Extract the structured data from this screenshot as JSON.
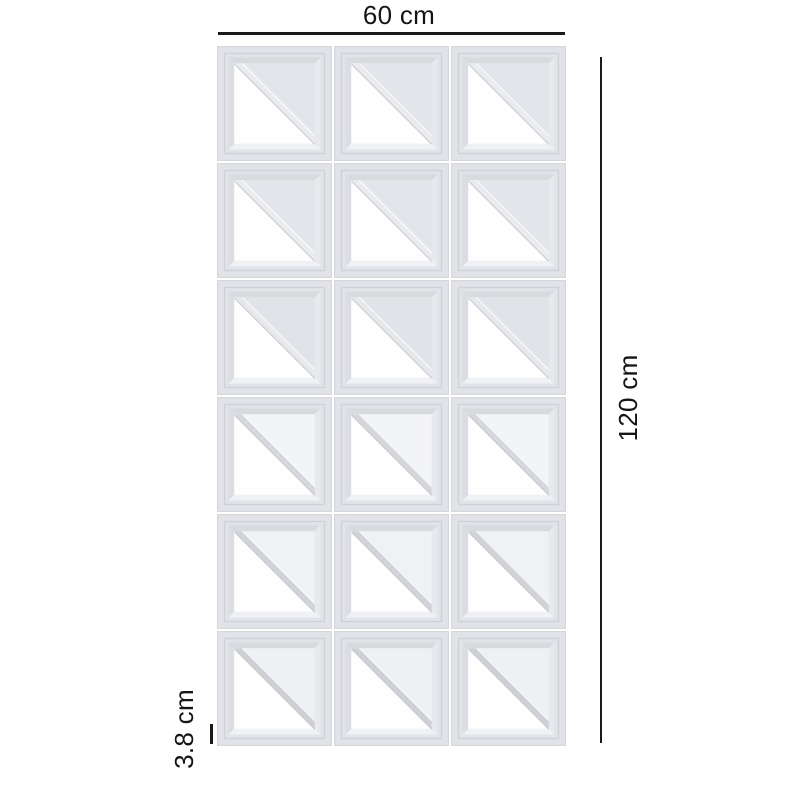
{
  "canvas": {
    "background": "#ffffff"
  },
  "product": {
    "name": "3D breeze-block wall panel with diagonal triangle cutouts",
    "grid": {
      "rows": 6,
      "cols": 3,
      "tile_count": 18
    }
  },
  "dimensions": {
    "width_label": "60 cm",
    "height_label": "120 cm",
    "thickness_label": "3.8 cm"
  },
  "colors": {
    "dimension_line": "#1a1a1a",
    "label_text": "#151515",
    "tile_face": "#e2e3e8",
    "tile_edge": "#d6d7db",
    "tile_groove": "#d0d1d7",
    "wall_top": "#d8dade",
    "wall_left": "#dcdde2",
    "wall_right": "#e8e9ed",
    "wall_bottom": "#f0f1f4",
    "opening_white": "#fefefe",
    "hypotenuse_edge": "#c2c3c8",
    "strut_highlight": "#fafbfc"
  },
  "tile_rows": [
    {
      "inner_face": "#e4e5ea",
      "strut": "#eaebef"
    },
    {
      "inner_face": "#e4e5ea",
      "strut": "#eaebef"
    },
    {
      "inner_face": "#e2e3e8",
      "strut": "#e7e8ec"
    },
    {
      "inner_face": "#f3f4f7",
      "strut": "#d6d7dd"
    },
    {
      "inner_face": "#f0f1f5",
      "strut": "#d2d3d9"
    },
    {
      "inner_face": "#eef0f3",
      "strut": "#cfd0d6"
    }
  ]
}
